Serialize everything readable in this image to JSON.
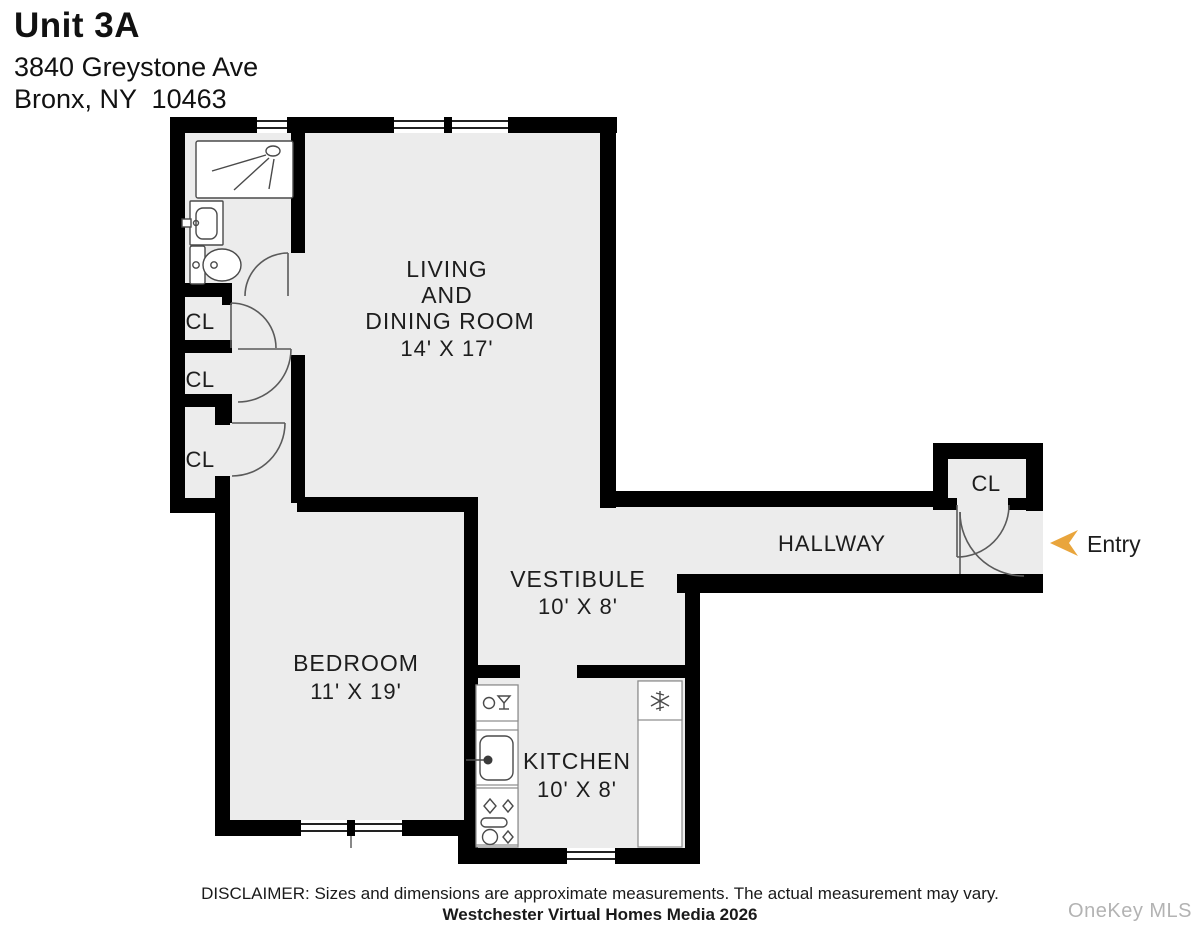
{
  "header": {
    "unit": "Unit 3A",
    "address1": "3840 Greystone Ave",
    "address2": "Bronx, NY  10463"
  },
  "rooms": {
    "living": {
      "l1": "LIVING",
      "l2": "AND",
      "l3": "DINING ROOM",
      "dims": "14' X 17'"
    },
    "bedroom": {
      "name": "BEDROOM",
      "dims": "11' X 19'"
    },
    "kitchen": {
      "name": "KITCHEN",
      "dims": "10' X 8'"
    },
    "vestibule": {
      "name": "VESTIBULE",
      "dims": "10' X 8'"
    },
    "hallway": {
      "name": "HALLWAY"
    },
    "closet1": {
      "name": "CL"
    },
    "closet2": {
      "name": "CL"
    },
    "closet3": {
      "name": "CL"
    },
    "entry_closet": {
      "name": "CL"
    }
  },
  "entry": {
    "label": "Entry"
  },
  "footer": {
    "disclaimer": "DISCLAIMER: Sizes and dimensions are approximate measurements. The actual measurement may vary.",
    "credit": "Westchester Virtual Homes Media 2026",
    "watermark": "OneKey MLS"
  },
  "colors": {
    "wall": "#000000",
    "floor": "#ECECEC",
    "text": "#1D1D1D",
    "arrow": "#E9A53C",
    "watermark": "#B3B3B3"
  }
}
